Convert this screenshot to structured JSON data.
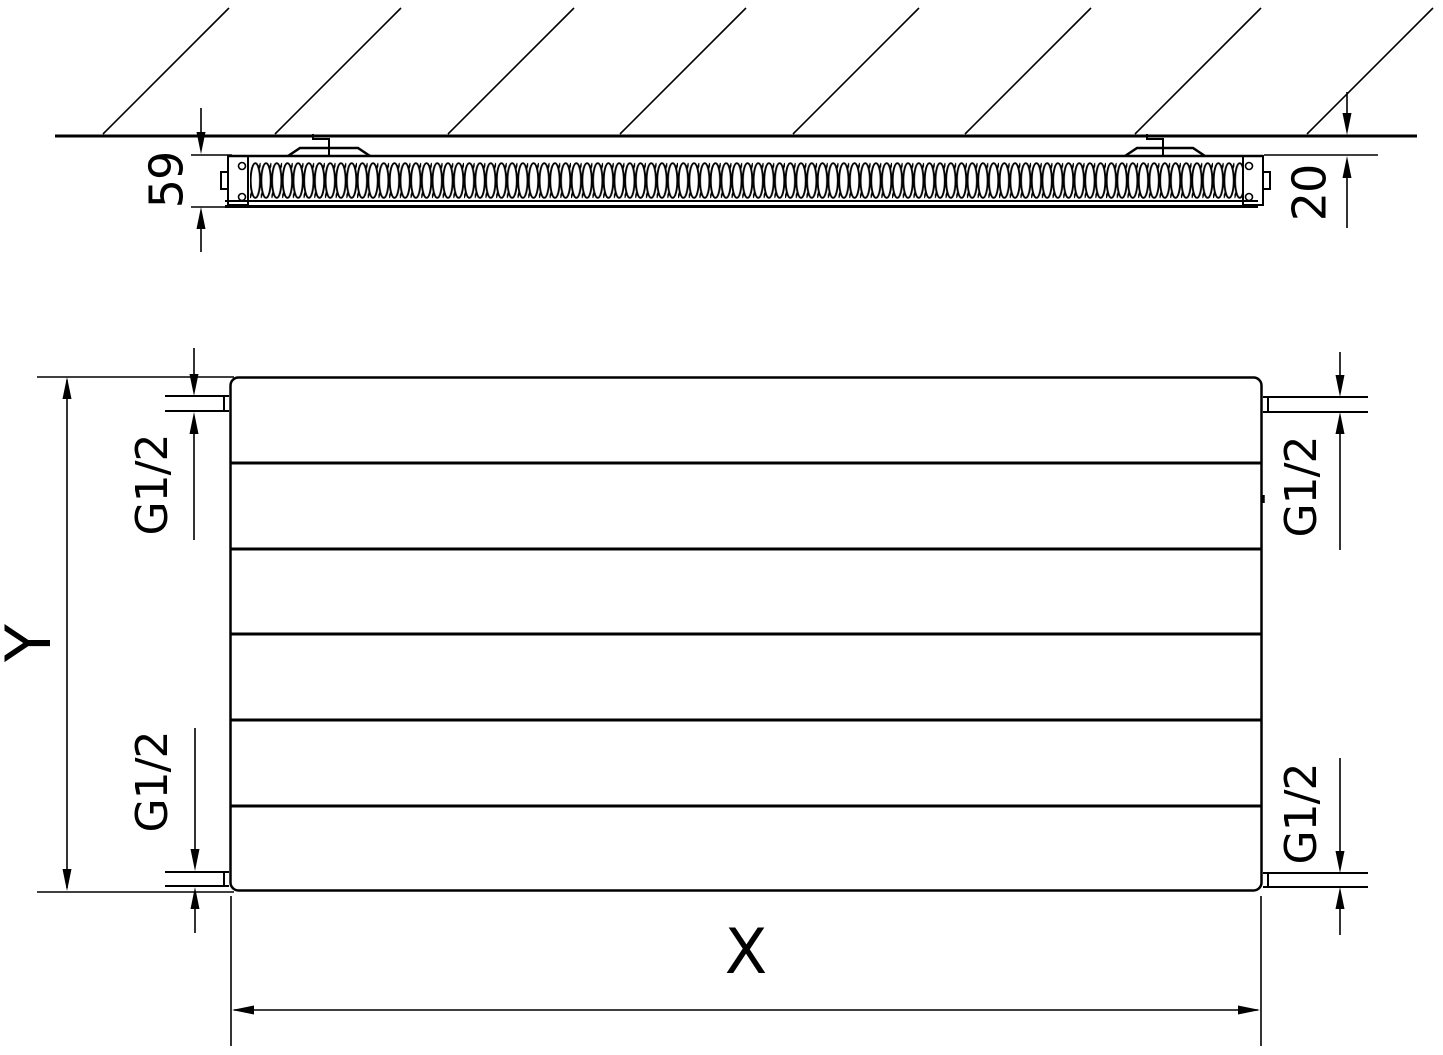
{
  "document": {
    "kind": "radiator-technical-drawing",
    "background": "#ffffff",
    "ink": "#000000"
  },
  "top_view": {
    "depth": "59",
    "wall_clearance": "20"
  },
  "front_view": {
    "height": "Y",
    "width": "X",
    "thread_top_left": "G1/2",
    "thread_top_right": "G1/2",
    "thread_bottom_left": "G1/2",
    "thread_bottom_right": "G1/2"
  }
}
